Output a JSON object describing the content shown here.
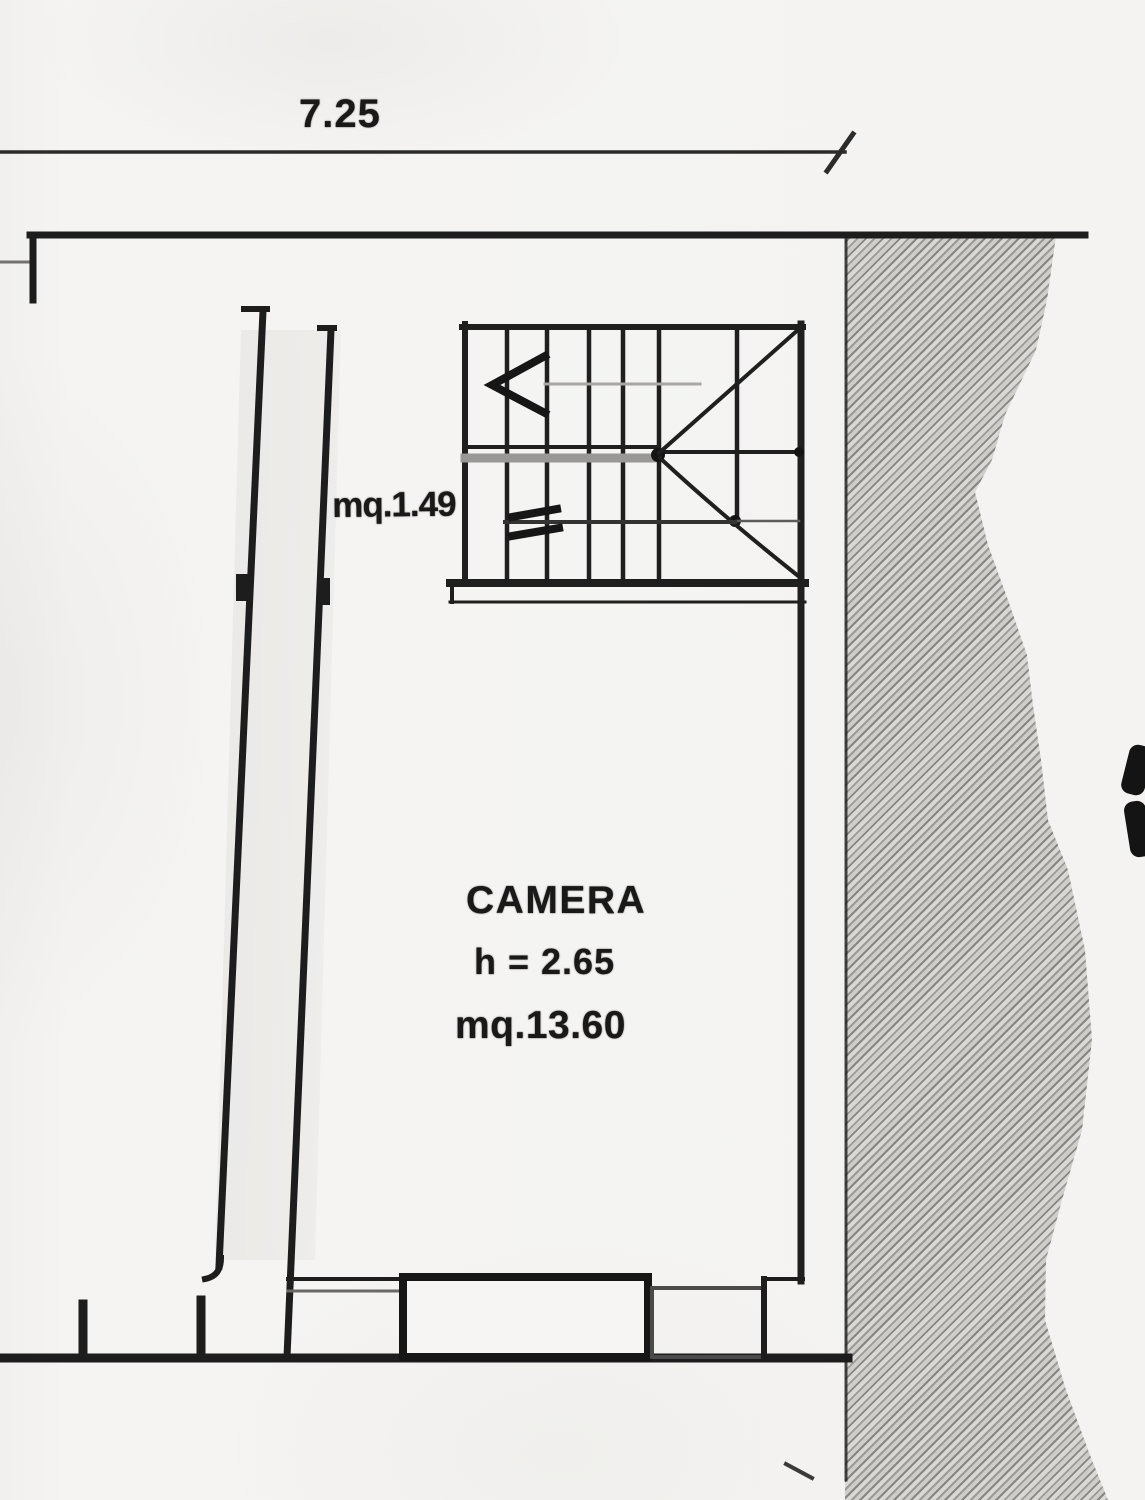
{
  "document": {
    "kind": "scanned architectural floor plan (Italian)",
    "colors": {
      "paper": "#f4f3f1",
      "ink": "#1c1c1c",
      "hatch_dark": "#7e7c79",
      "hatch_light": "#d8d6d3",
      "faint_line": "#9a9896"
    }
  },
  "dimension": {
    "top_width": "7.25"
  },
  "rooms": {
    "stairwell": {
      "area_label": "mq.1.49"
    },
    "camera": {
      "name": "CAMERA",
      "height_label": "h = 2.65",
      "area_label": "mq.13.60"
    }
  }
}
